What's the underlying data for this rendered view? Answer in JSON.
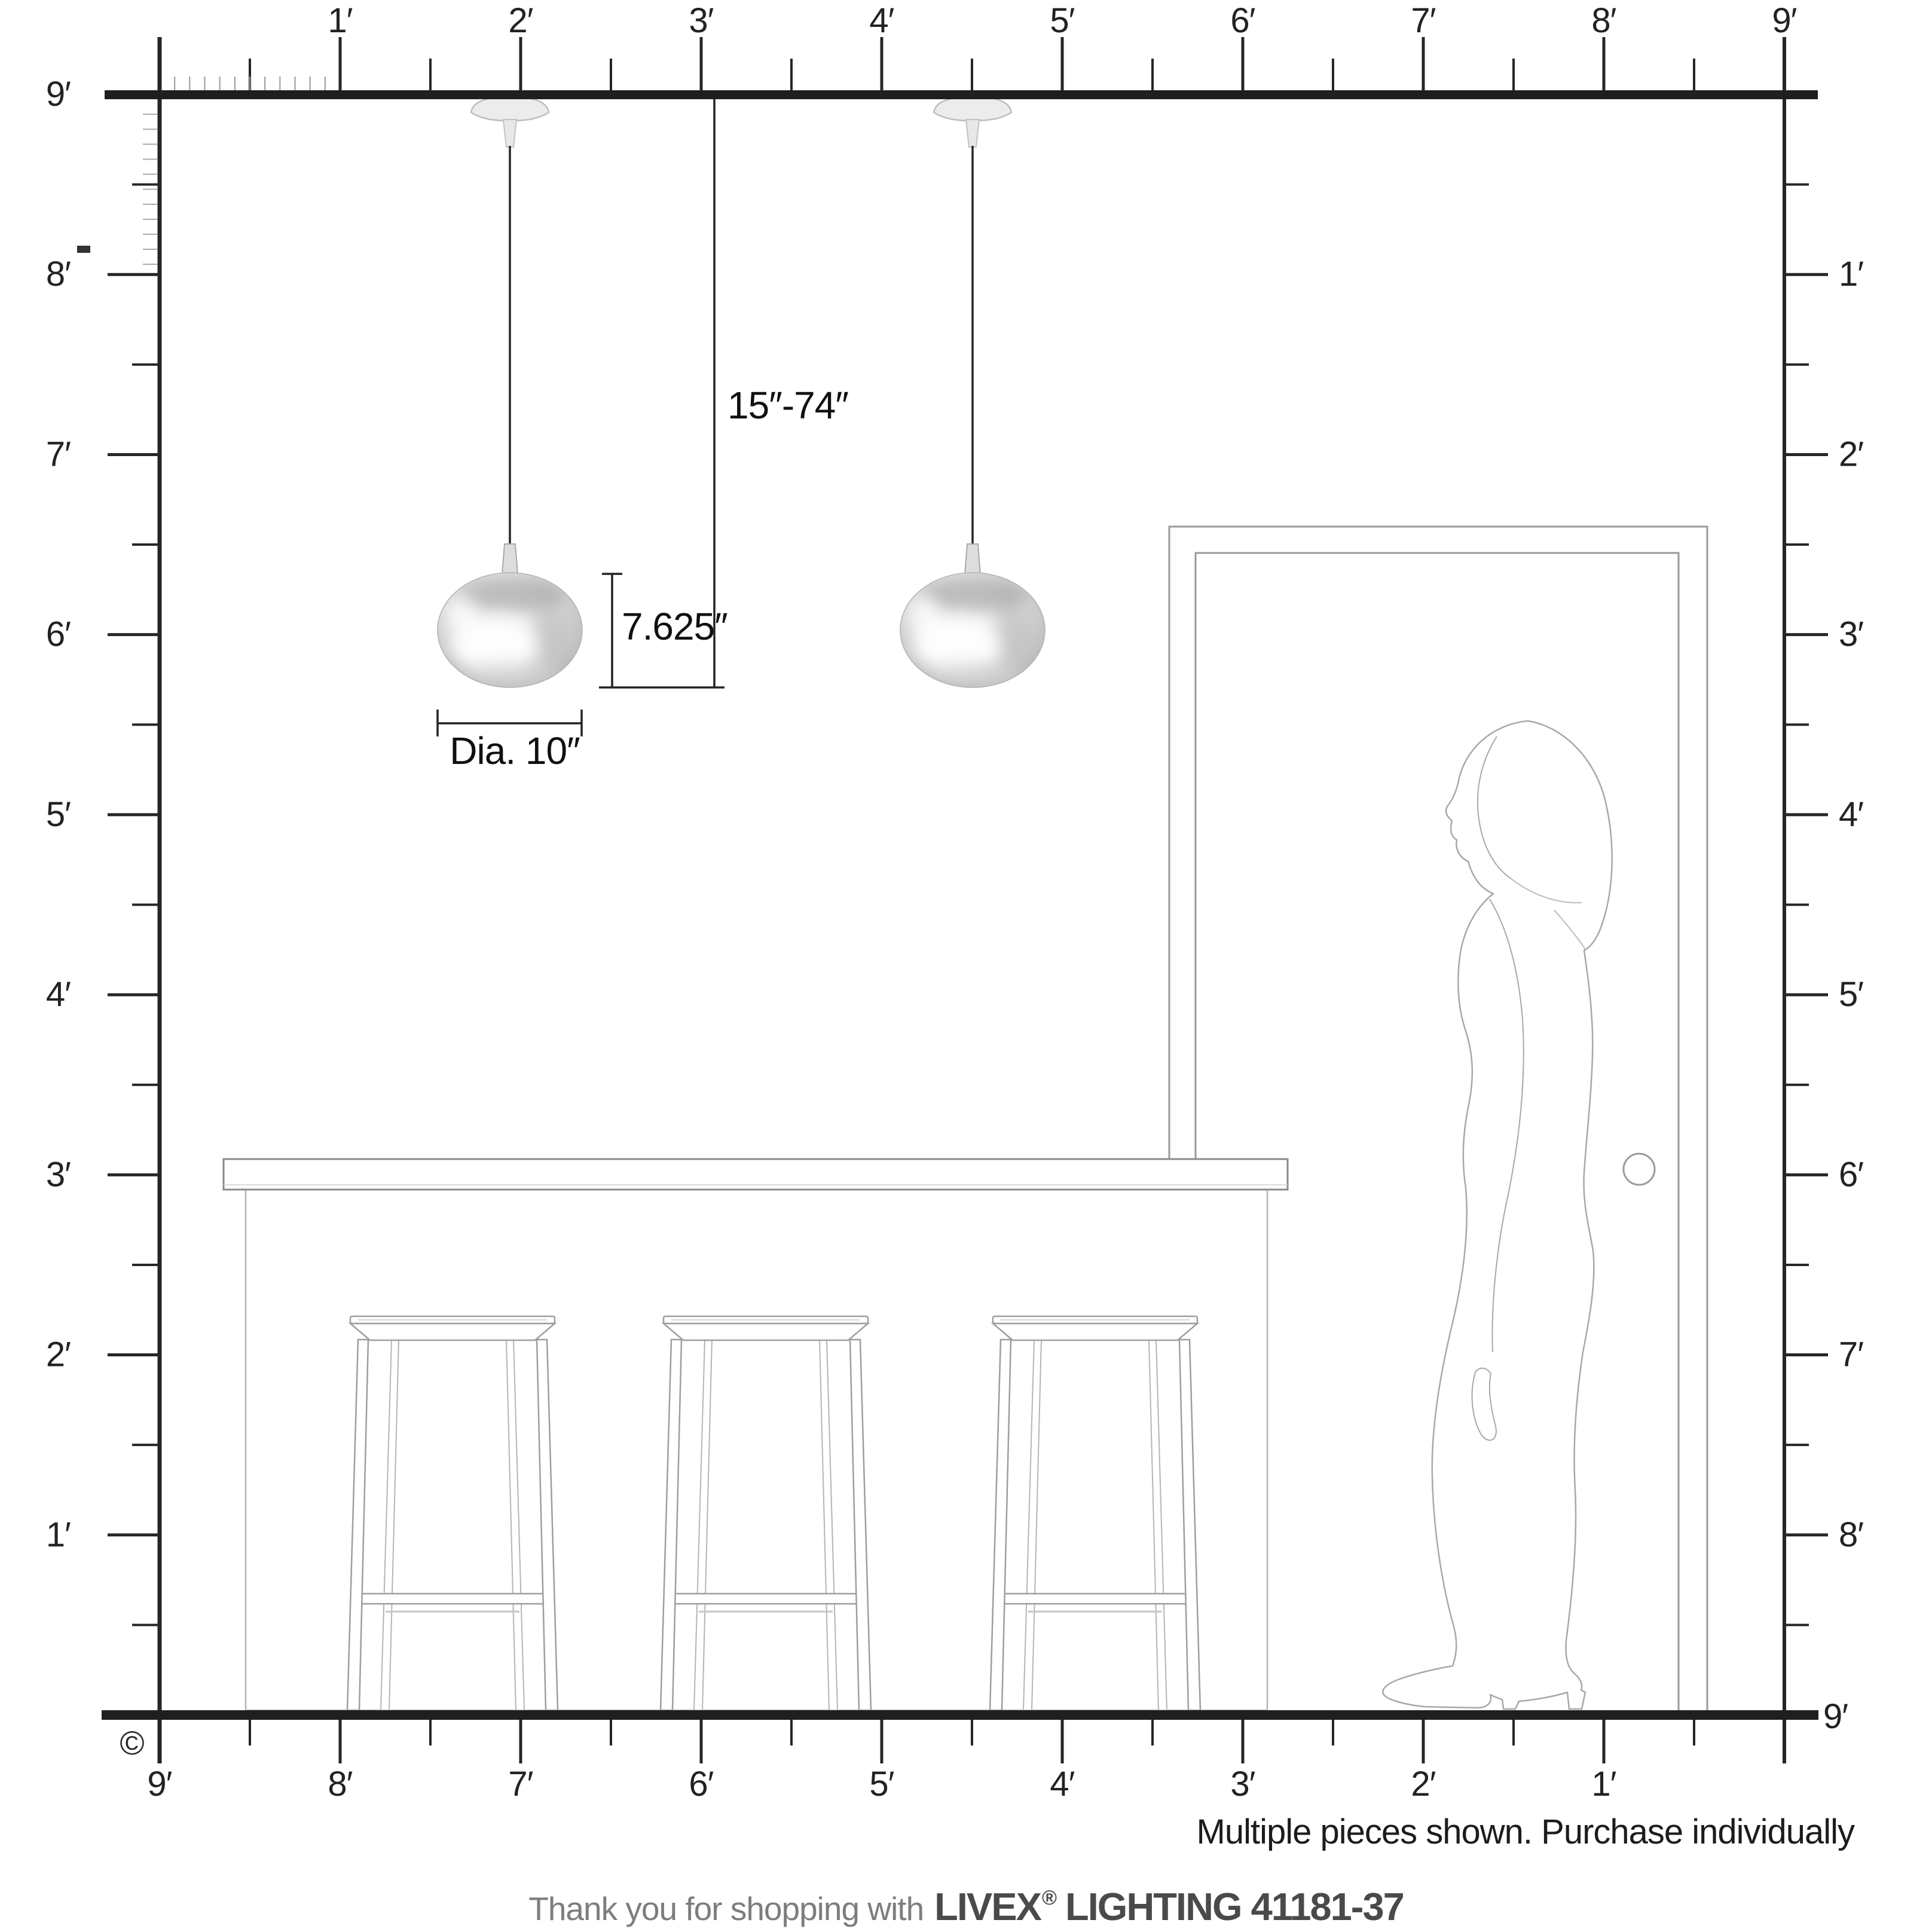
{
  "product": {
    "brand": "LIVEX",
    "registered_mark": "®",
    "line": "LIGHTING",
    "model": "41181-37"
  },
  "rulers": {
    "unit": "feet",
    "top": {
      "labels": [
        "1′",
        "2′",
        "3′",
        "4′",
        "5′",
        "6′",
        "7′",
        "8′",
        "9′"
      ]
    },
    "left": {
      "ceiling_label": "9′",
      "labels": [
        "8′",
        "7′",
        "6′",
        "5′",
        "4′",
        "3′",
        "2′",
        "1′"
      ]
    },
    "right": {
      "labels": [
        "1′",
        "2′",
        "3′",
        "4′",
        "5′",
        "6′",
        "7′",
        "8′"
      ],
      "floor_label": "9′"
    },
    "bottom": {
      "labels": [
        "9′",
        "8′",
        "7′",
        "6′",
        "5′",
        "4′",
        "3′",
        "2′",
        "1′"
      ]
    }
  },
  "dimensions": {
    "suspension_range": "15″-74″",
    "fixture_height": "7.625″",
    "diameter": "Dia. 10″"
  },
  "annotations": {
    "note": "Multiple pieces shown. Purchase individually",
    "copyright": "©"
  },
  "footer": {
    "prefix": "Thank you for shopping with",
    "brand": "LIVEX",
    "registered": "®",
    "suffix": "LIGHTING 41181-37"
  },
  "colors": {
    "background": "#ffffff",
    "bar": "#1f1f1f",
    "tick": "#262626",
    "tick_minor": "#999999",
    "label": "#222222",
    "dimension_line": "#222222",
    "furniture_outline": "#9e9e9e",
    "furniture_light": "#b5b5b5",
    "silhouette": "#a8a8a8",
    "chrome_light": "#f6f6f6",
    "chrome_mid": "#cfcfcf",
    "chrome_dark": "#b9b9b9"
  }
}
